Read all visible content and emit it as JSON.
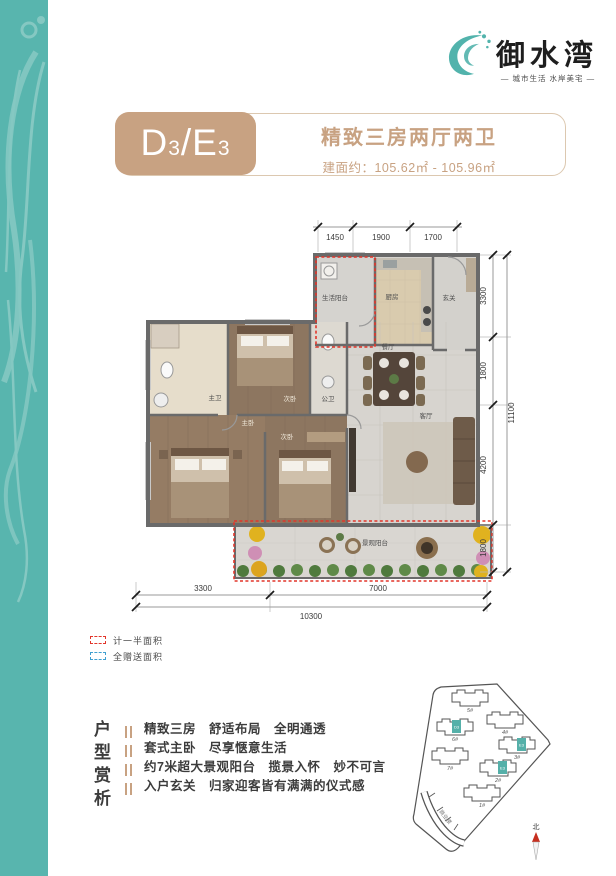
{
  "colors": {
    "teal": "#58b5ae",
    "accent_tan": "#c8a282",
    "dash_red": "#e2352a",
    "dash_blue": "#3f9fd0"
  },
  "brand": {
    "name": "御水湾",
    "tagline": "— 城市生活 水岸美宅 —"
  },
  "header": {
    "unit_d": "D",
    "unit_d_sub": "3",
    "unit_slash": "/",
    "unit_e": "E",
    "unit_e_sub": "3",
    "title": "精致三房两厅两卫",
    "area": "建面约：105.62㎡ - 105.96㎡"
  },
  "floorplan": {
    "dims_top": [
      "1450",
      "1900",
      "1700"
    ],
    "dims_right": [
      "3300",
      "1800",
      "4200",
      "1800"
    ],
    "dim_right_total": "11100",
    "dims_bottom": [
      "3300",
      "7000"
    ],
    "dim_bottom_total": "10300",
    "rooms": {
      "laundry_balcony": "生活阳台",
      "kitchen": "厨房",
      "foyer": "玄关",
      "dining": "餐厅",
      "living": "客厅",
      "master_bath": "主卫",
      "bedroom2": "次卧",
      "public_bath": "公卫",
      "master_bedroom": "主卧",
      "bedroom3": "次卧",
      "view_balcony": "景观阳台"
    }
  },
  "legend": {
    "half_area": "计一半面积",
    "gift_area": "全赠送面积"
  },
  "analysis": {
    "title": "户型赏析",
    "lines": [
      "精致三房　舒适布局　全明通透",
      "套式主卧　尽享惬意生活",
      "约7米超大景观阳台　揽景入怀　妙不可言",
      "入户玄关　归家迎客皆有满满的仪式感"
    ]
  },
  "sitemap": {
    "buildings": [
      "5#",
      "4#",
      "6#",
      "3#",
      "7#",
      "2#",
      "1#"
    ],
    "commercial": "商业楼",
    "north_label": "北",
    "highlight_labels": [
      "D3",
      "E3",
      "E3"
    ]
  }
}
